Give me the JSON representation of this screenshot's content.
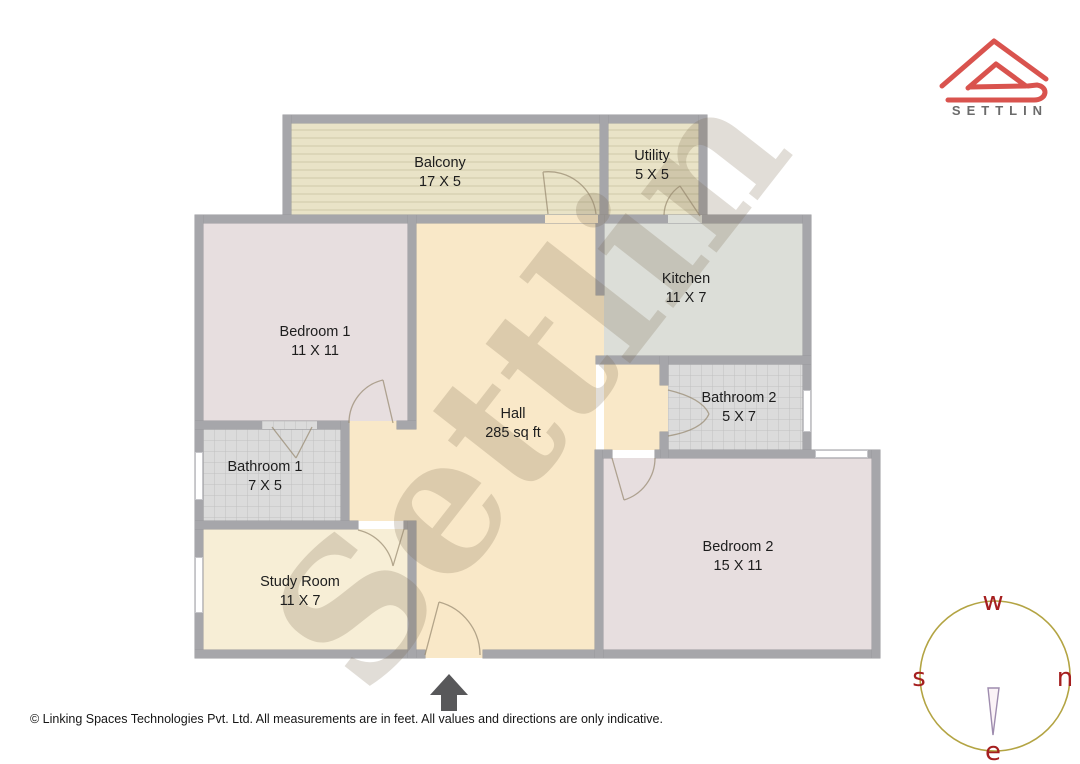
{
  "brand": {
    "logo_text": "SETTLIN"
  },
  "watermark": "Settlin",
  "rooms": {
    "balcony": {
      "name": "Balcony",
      "dims": "17 X 5"
    },
    "utility": {
      "name": "Utility",
      "dims": "5 X 5"
    },
    "kitchen": {
      "name": "Kitchen",
      "dims": "11 X 7"
    },
    "bedroom1": {
      "name": "Bedroom 1",
      "dims": "11 X 11"
    },
    "bathroom2": {
      "name": "Bathroom 2",
      "dims": "5 X 7"
    },
    "hall": {
      "name": "Hall",
      "dims": "285 sq ft"
    },
    "bathroom1": {
      "name": "Bathroom 1",
      "dims": "7 X 5"
    },
    "study": {
      "name": "Study Room",
      "dims": "11 X 7"
    },
    "bedroom2": {
      "name": "Bedroom 2",
      "dims": "15 X 11"
    }
  },
  "compass": {
    "top": "w",
    "left": "s",
    "right": "n",
    "bottom": "e"
  },
  "footer": {
    "text": "© Linking Spaces Technologies Pvt. Ltd. All measurements are in feet. All values and directions are only indicative."
  },
  "colors": {
    "wall": "#a6a6aa",
    "hall": "#f9e8c8",
    "bedroom": "#e7dedf",
    "kitchen": "#dcded8",
    "bathroom": "#dbdbdb",
    "balcony": "#e9e3c7",
    "study": "#f7eed6",
    "logo_red": "#d9534e",
    "logo_text_gray": "#6b6b6b",
    "compass_circle": "#b3a443",
    "compass_letters": "#a51f1f",
    "entrance_arrow": "#58585a",
    "watermark": "rgba(120,100,75,0.22)"
  }
}
